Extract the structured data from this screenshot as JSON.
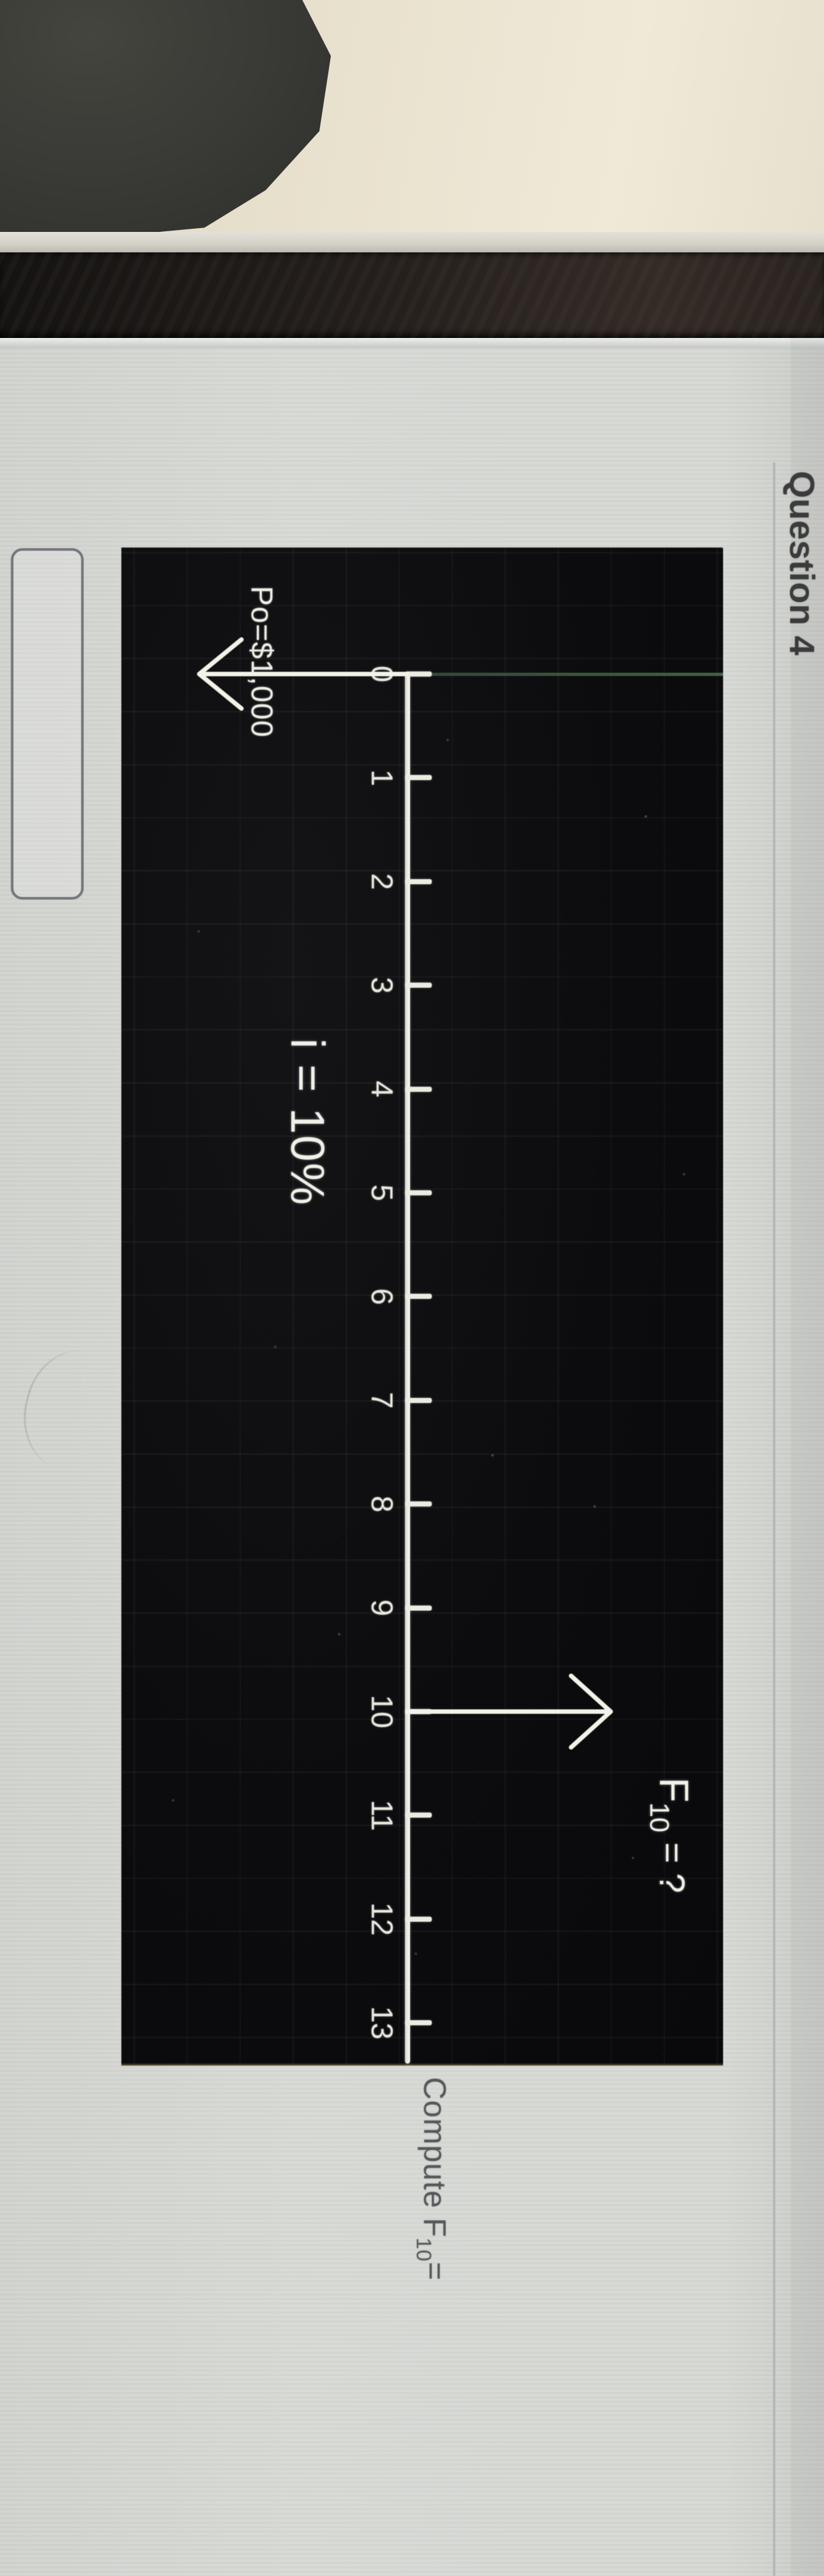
{
  "header": {
    "title": "Question 4"
  },
  "diagram": {
    "type": "cash-flow-timeline",
    "tick_labels": [
      "0",
      "1",
      "2",
      "3",
      "4",
      "5",
      "6",
      "7",
      "8",
      "9",
      "10",
      "11",
      "12",
      "13"
    ],
    "interest_label": "i = 10%",
    "arrows": [
      {
        "t": 0,
        "direction": "down",
        "label": "Po=$1,000"
      },
      {
        "t": 10,
        "direction": "up",
        "label_base": "F",
        "label_sub": "10",
        "label_rest": " = ?"
      }
    ]
  },
  "compute": {
    "prefix": "Compute F",
    "sub": "10",
    "suffix": "="
  },
  "answer_input": {
    "value": "",
    "placeholder": ""
  }
}
